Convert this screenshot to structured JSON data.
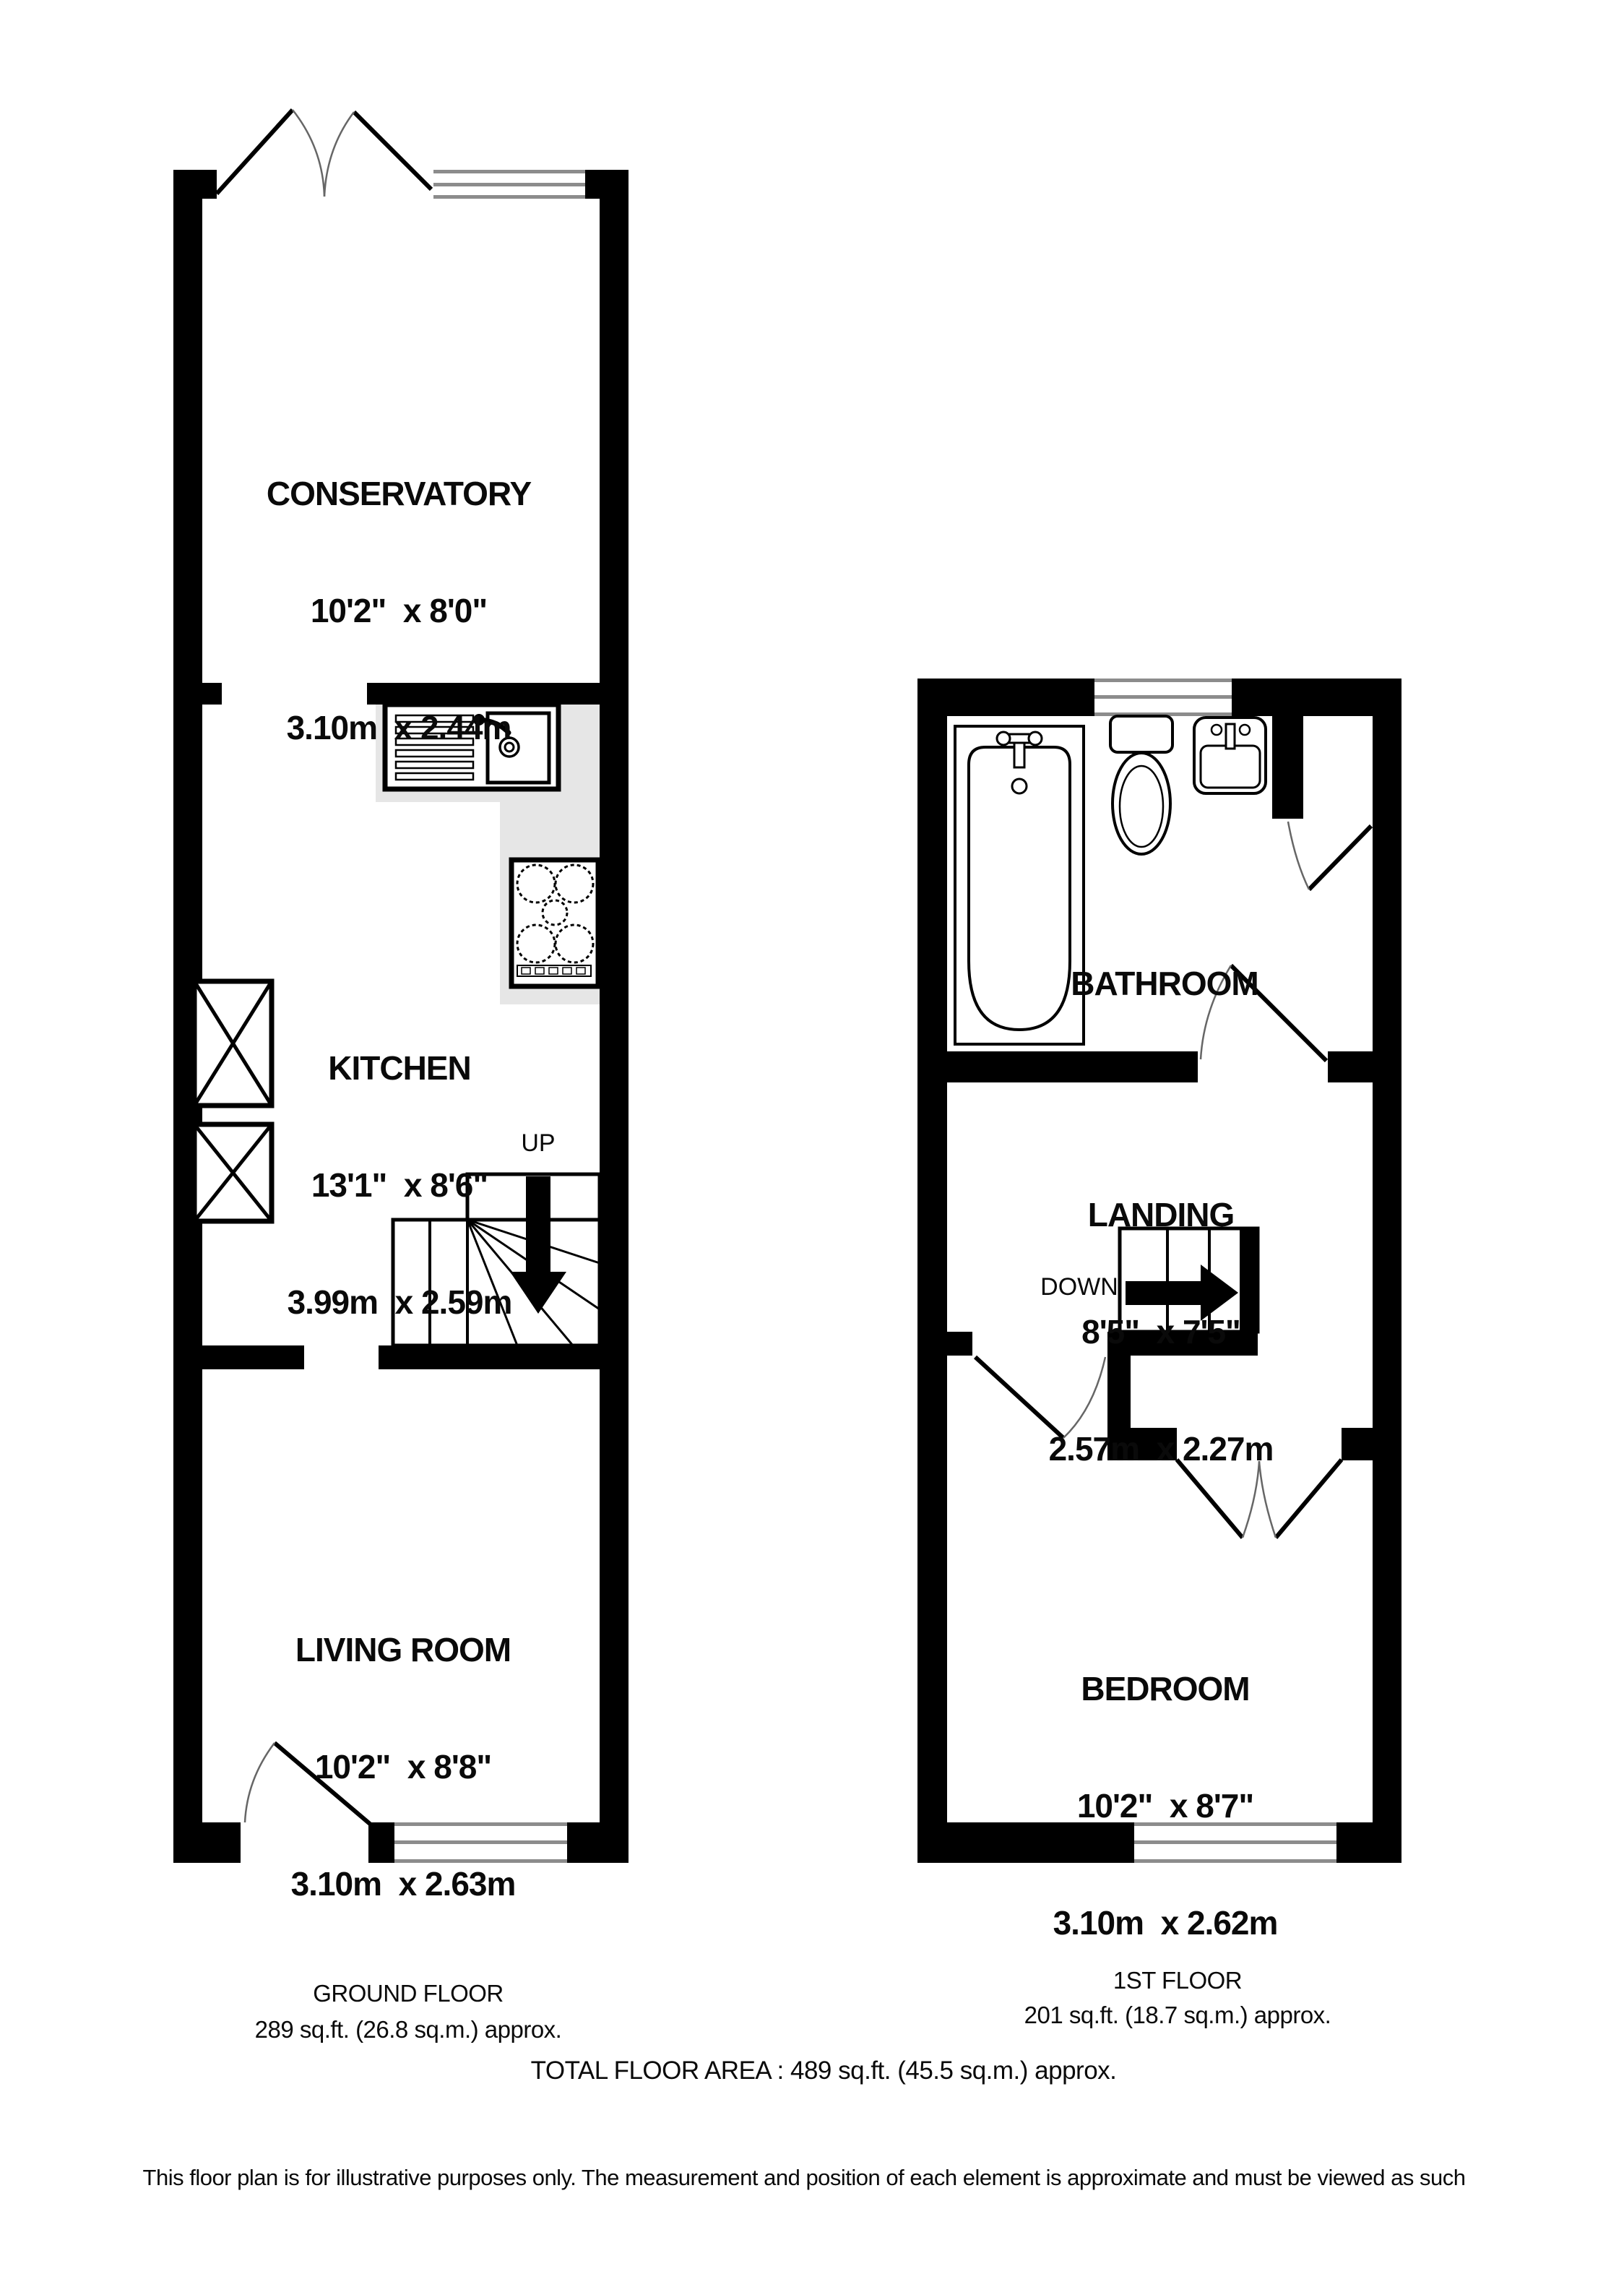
{
  "ground_floor": {
    "rooms": {
      "conservatory": {
        "name": "CONSERVATORY",
        "imperial": "10'2\"  x 8'0\"",
        "metric": "3.10m  x 2.44m"
      },
      "kitchen": {
        "name": "KITCHEN",
        "imperial": "13'1\"  x 8'6\"",
        "metric": "3.99m  x 2.59m"
      },
      "living_room": {
        "name": "LIVING ROOM",
        "imperial": "10'2\"  x 8'8\"",
        "metric": "3.10m  x 2.63m"
      }
    },
    "stairs_label": "UP",
    "caption": {
      "title": "GROUND FLOOR",
      "area": "289 sq.ft. (26.8 sq.m.) approx."
    }
  },
  "first_floor": {
    "rooms": {
      "bathroom": {
        "name": "BATHROOM"
      },
      "landing": {
        "name": "LANDING",
        "imperial": "8'5\"  x 7'5\"",
        "metric": "2.57m  x 2.27m"
      },
      "bedroom": {
        "name": "BEDROOM",
        "imperial": "10'2\"  x 8'7\"",
        "metric": "3.10m  x 2.62m"
      }
    },
    "stairs_label": "DOWN",
    "caption": {
      "title": "1ST FLOOR",
      "area": "201 sq.ft. (18.7 sq.m.) approx."
    }
  },
  "footer": {
    "total": "TOTAL FLOOR AREA : 489 sq.ft. (45.5 sq.m.) approx.",
    "disclaimer": "This floor plan is for illustrative purposes only. The measurement and position of each element is approximate and must be viewed as such"
  },
  "colors": {
    "wall": "#000000",
    "counter": "#e6e6e6",
    "window_line": "#8c8c8c",
    "door_arc": "#666666",
    "text": "#0a0a0a"
  },
  "icons": {
    "french-doors-icon": "double door leaves with quarter arcs",
    "door-icon": "leaf line with quarter arc",
    "window-icon": "triple gray line band",
    "sink-icon": "drainer lines + basin + tap",
    "hob-icon": "4 large + 1 small dashed burner circles with control strip",
    "appliance-icon": "box with X cross",
    "stairs-up-icon": "treads + winder fan + down arrow",
    "stairs-down-icon": "treads + right arrow",
    "bath-icon": "tub with mixer tap and drain",
    "toilet-icon": "cistern + oval bowl",
    "basin-icon": "rounded basin with tap"
  }
}
